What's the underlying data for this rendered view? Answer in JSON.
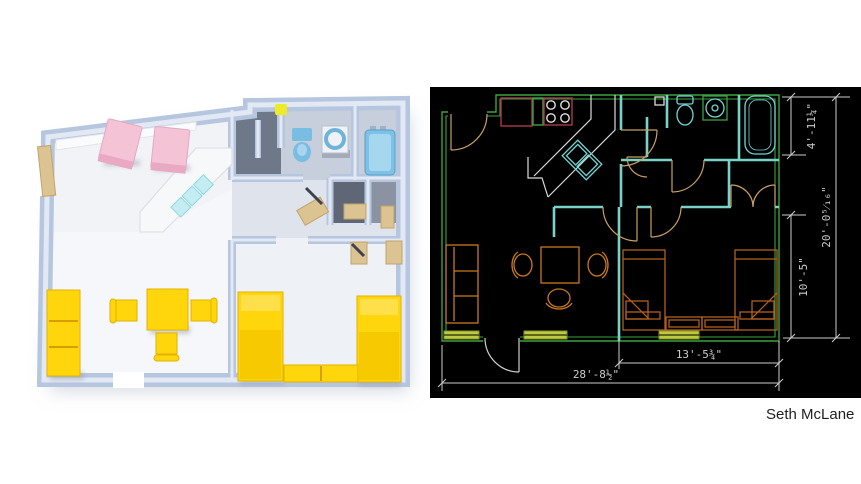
{
  "page": {
    "author": "Seth McLane",
    "background": "#ffffff",
    "author_color": "#1f1f1f"
  },
  "cad": {
    "background": "#000000",
    "colors": {
      "wall_green": "#3aa341",
      "wall_teal": "#79d2c8",
      "door_tan": "#c9a063",
      "furniture_orange": "#c8791f",
      "bed_brown": "#b35f1e",
      "kitchen_red": "#ab3a48",
      "fixture_cyan": "#6fd6d6",
      "counter_white": "#dcdcdc",
      "window_yellow": "#bcca3e",
      "dim_gray": "#cdcdcd"
    },
    "dimensions": {
      "bath_width": "4'-11¼\"",
      "overall_depth": "20'-0⁵⁄₁₆\"",
      "bedroom_depth": "10'-5\"",
      "bedroom_width": "13'-5¾\"",
      "overall_width": "28'-8½\""
    }
  },
  "render3d": {
    "colors": {
      "wall_blue": "#b7c6df",
      "wall_top": "#e2e9f4",
      "floor": "#f6f7fa",
      "alcove_gray": "#6f7888",
      "furniture_yellow": "#ffd60b",
      "chair_pink": "#f4c3d6",
      "fixture_blue": "#7abde2",
      "door_tan": "#dcc392",
      "counter_white": "#f7f8fa",
      "sink_cyan": "#c3edf3",
      "accent_dot": "#eeea25"
    }
  }
}
